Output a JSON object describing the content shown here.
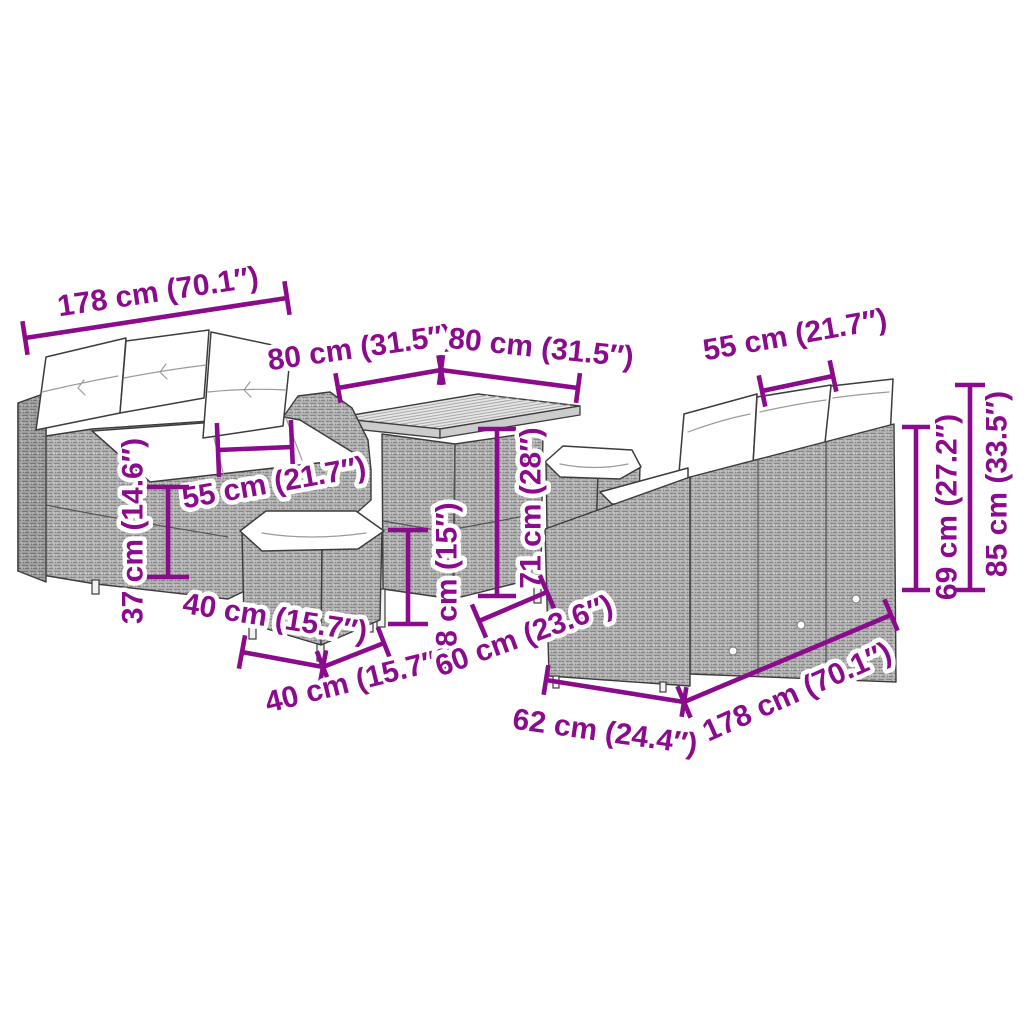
{
  "diagram": {
    "type": "product-dimension-diagram",
    "subject": "garden-furniture-lounge-set",
    "colors": {
      "accent": "#8a0b8c",
      "background": "#ffffff",
      "rattan_gray": "#b3b3b3",
      "cushion_white": "#ffffff",
      "outline": "#3c3c3c"
    },
    "furniture": [
      {
        "name": "sofa-3-seater-left"
      },
      {
        "name": "dining-table"
      },
      {
        "name": "ottoman-left"
      },
      {
        "name": "ottoman-right"
      },
      {
        "name": "sofa-3-seater-right"
      }
    ],
    "dimensions": [
      {
        "id": "178-top-left",
        "label": "178 cm (70.1″)",
        "lx": 158,
        "ly": 292,
        "rot": -8.5,
        "line": [
          25,
          338,
          287,
          298
        ],
        "tick": 17
      },
      {
        "id": "80-table-left",
        "label": "80 cm (31.5″)",
        "lx": 360,
        "ly": 348,
        "rot": -8,
        "line": [
          338,
          388,
          441,
          370
        ],
        "tick": 15
      },
      {
        "id": "80-table-right",
        "label": "80 cm (31.5″)",
        "lx": 541,
        "ly": 348,
        "rot": 6,
        "line": [
          441,
          370,
          578,
          388
        ],
        "tick": 15
      },
      {
        "id": "55-sofa-right",
        "label": "55 cm (21.7″)",
        "lx": 795,
        "ly": 335,
        "rot": -10,
        "line": [
          762,
          391,
          833,
          376
        ],
        "tick": 16
      },
      {
        "id": "55-sofa-left",
        "label": "55 cm (21.7″)",
        "lx": 274,
        "ly": 483,
        "rot": -10,
        "line": [
          218,
          450,
          292,
          447
        ],
        "tick": 27
      },
      {
        "id": "37-seat-height",
        "label": "37 cm (14.6″)",
        "lx": 133,
        "ly": 531,
        "rot": -90,
        "line": [
          168,
          487,
          168,
          577
        ],
        "tick": 21
      },
      {
        "id": "40-ottoman-front",
        "label": "40 cm (15.7″)",
        "lx": 275,
        "ly": 618,
        "rot": 9,
        "line": [
          242,
          652,
          323,
          667
        ],
        "tick": 17
      },
      {
        "id": "40-ottoman-side",
        "label": "40 cm (15.7″)",
        "lx": 356,
        "ly": 681,
        "rot": -14,
        "line": [
          323,
          667,
          384,
          643
        ],
        "tick": 17
      },
      {
        "id": "38-table-shelf",
        "label": "38 cm (15″)",
        "lx": 447,
        "ly": 583,
        "rot": -90,
        "line": [
          408,
          530,
          408,
          624
        ],
        "tick": 20
      },
      {
        "id": "71-table-height",
        "label": "71 cm (28″)",
        "lx": 531,
        "ly": 508,
        "rot": -90,
        "line": [
          497,
          429,
          497,
          596
        ],
        "tick": 19
      },
      {
        "id": "60-table-base",
        "label": "60 cm (23.6″)",
        "lx": 524,
        "ly": 636,
        "rot": -20,
        "line": [
          479,
          621,
          547,
          592
        ],
        "tick": 18
      },
      {
        "id": "62-sofa-depth",
        "label": "62 cm (24.4″)",
        "lx": 605,
        "ly": 732,
        "rot": 8,
        "line": [
          546,
          680,
          684,
          702
        ],
        "tick": 15
      },
      {
        "id": "178-bottom-right",
        "label": "178 cm (70.1″)",
        "lx": 797,
        "ly": 692,
        "rot": -24,
        "line": [
          684,
          702,
          891,
          615
        ],
        "tick": 17
      },
      {
        "id": "69-back-height",
        "label": "69 cm (27.2″)",
        "lx": 947,
        "ly": 507,
        "rot": -90,
        "line": [
          916,
          427,
          916,
          590
        ],
        "tick": 14
      },
      {
        "id": "85-total-height",
        "label": "85 cm (33.5″)",
        "lx": 997,
        "ly": 484,
        "rot": -90,
        "line": [
          970,
          385,
          970,
          590
        ],
        "tick": 15
      }
    ]
  }
}
